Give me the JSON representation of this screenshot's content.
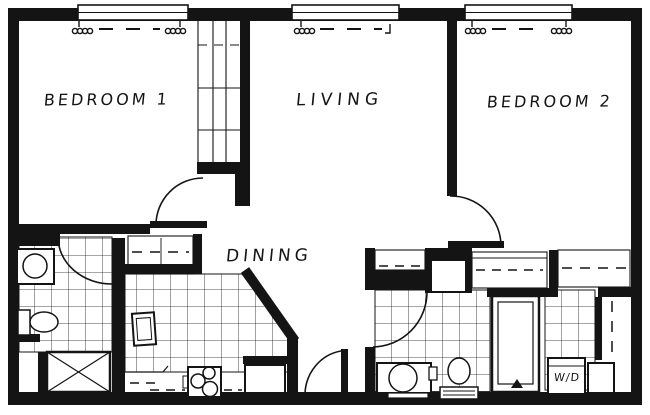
{
  "colors": {
    "ink": "#141414",
    "background": "#ffffff"
  },
  "rooms": {
    "bedroom1": {
      "label": "BEDROOM 1"
    },
    "living": {
      "label": "LIVING"
    },
    "bedroom2": {
      "label": "BEDROOM 2"
    },
    "dining": {
      "label": "DINING"
    },
    "laundry": {
      "label": "W/D"
    }
  }
}
